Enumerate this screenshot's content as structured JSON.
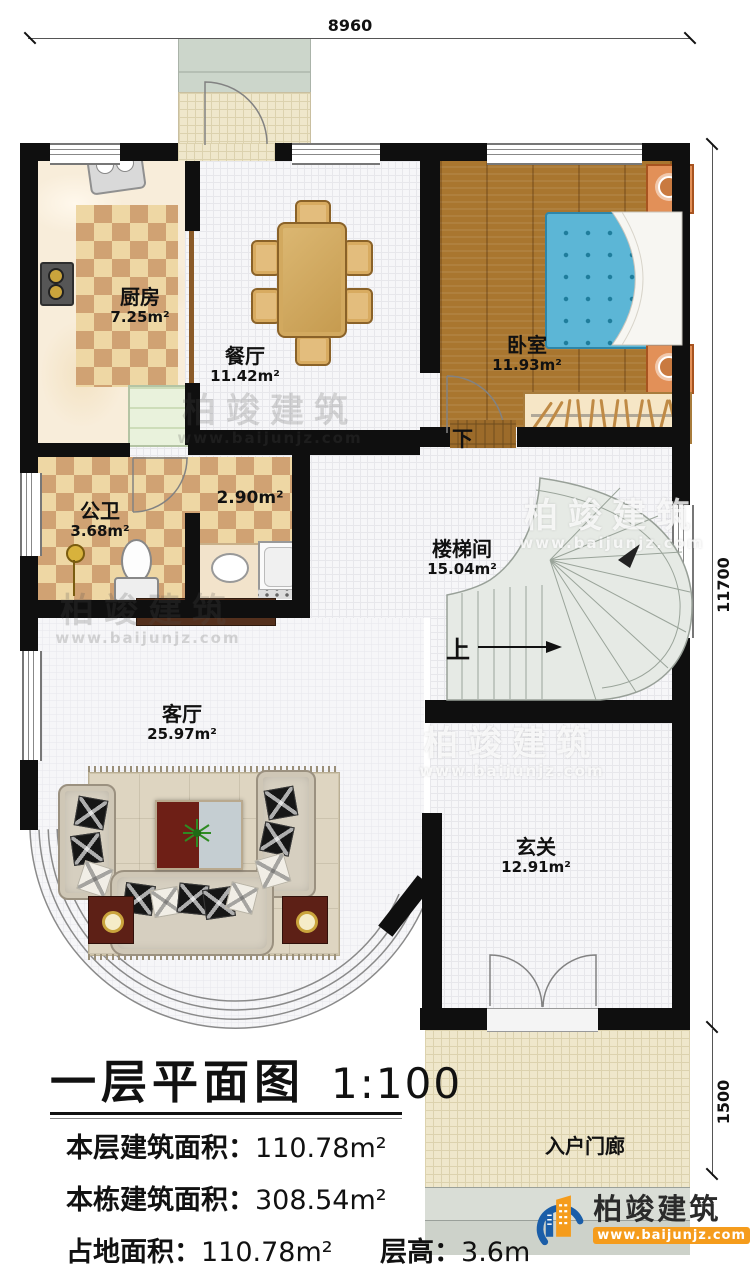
{
  "plan": {
    "title": "一层平面图",
    "scale": "1:100"
  },
  "dimensions": {
    "width_top": "8960",
    "height_right": "11700",
    "porch_depth": "1500"
  },
  "rooms": {
    "kitchen": {
      "name": "厨房",
      "area": "7.25m²"
    },
    "dining": {
      "name": "餐厅",
      "area": "11.42m²"
    },
    "bedroom": {
      "name": "卧室",
      "area": "11.93m²"
    },
    "bathroom": {
      "name": "公卫",
      "area": "3.68m²"
    },
    "utility": {
      "area": "2.90m²"
    },
    "stairwell": {
      "name": "楼梯间",
      "area": "15.04m²"
    },
    "living": {
      "name": "客厅",
      "area": "25.97m²"
    },
    "foyer": {
      "name": "玄关",
      "area": "12.91m²"
    },
    "entry_porch": {
      "name": "入户门廊"
    }
  },
  "stairs": {
    "up_label": "上",
    "down_label": "下"
  },
  "info": {
    "floor_area_label": "本层建筑面积：",
    "floor_area_value": "110.78m²",
    "total_area_label": "本栋建筑面积：",
    "total_area_value": "308.54m²",
    "land_area_label": "占地面积：",
    "land_area_value": "110.78m²",
    "storey_height_label": "层高：",
    "storey_height_value": "3.6m"
  },
  "branding": {
    "company": "柏竣建筑",
    "website": "www.baijunjz.com"
  },
  "watermark": {
    "text": "柏竣建筑",
    "url": "www.baijunjz.com"
  },
  "colors": {
    "wall": "#0f0f0f",
    "checker_dark": "#d0a273",
    "checker_light": "#eed7a4",
    "wood": "#a9762f",
    "bed_blue": "#5cb6d6",
    "logo_blue": "#1b5ea8",
    "logo_orange": "#f59c1c"
  }
}
